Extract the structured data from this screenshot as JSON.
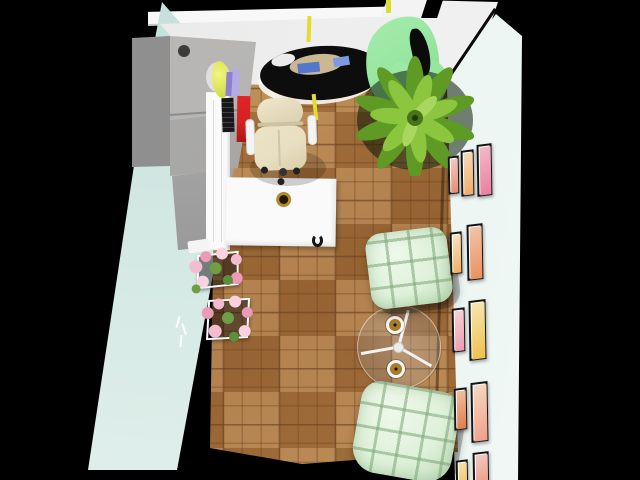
{
  "scene": {
    "type": "3d-room-render",
    "view": "top-down",
    "room": "home office",
    "objects": [
      {
        "id": "left-wall",
        "label": "Pale blue left wall"
      },
      {
        "id": "top-wall",
        "label": "White top wall"
      },
      {
        "id": "right-wall",
        "label": "Pale blue right wall with gallery of framed prints"
      },
      {
        "id": "parquet-floor",
        "label": "Oak square parquet floor"
      },
      {
        "id": "wardrobe",
        "label": "Grey wardrobe cabinet with round knob"
      },
      {
        "id": "desk",
        "label": "White L-shaped desk with brass knob"
      },
      {
        "id": "desk-books",
        "label": "Books and objects on desk: red book, dark book, purple books, lime lamp"
      },
      {
        "id": "office-chair",
        "label": "Cream office chair with white armrests and casters"
      },
      {
        "id": "round-black-table",
        "label": "Black round table with tableware decor"
      },
      {
        "id": "green-wave-decor",
        "label": "Green sculptural wave decor"
      },
      {
        "id": "potted-plant",
        "label": "Large green potted plant"
      },
      {
        "id": "tufted-chair-top",
        "label": "Mint tufted chair (upper)"
      },
      {
        "id": "tufted-chair-bottom",
        "label": "Mint tufted chair (lower)"
      },
      {
        "id": "glass-side-table",
        "label": "Round glass table with white tripod legs"
      },
      {
        "id": "brass-cups",
        "label": "Two brass cups on glass table",
        "count": 2
      },
      {
        "id": "flower-baskets",
        "label": "Two white wire baskets with pink flowers",
        "count": 2
      },
      {
        "id": "gallery-frames",
        "label": "Framed prints on right wall",
        "count": 11
      },
      {
        "id": "wall-sprig-decal",
        "label": "Small white sprig decal on left wall"
      }
    ],
    "counts": {
      "gallery_frames": 11,
      "flower_baskets": 2,
      "tufted_chairs": 2,
      "brass_cups": 2
    }
  },
  "colors": {
    "background": "#000000",
    "band-white": "#f8f8f8",
    "wall-left": "#d2e7e2",
    "wall-right": "#e9f4f1",
    "wall-top": "#ededed",
    "floor-base": "#b5824a",
    "floor-dark": "#a06b38",
    "cabinet-face": "#b2b1af",
    "cabinet-side": "#969696",
    "desk-white": "#fafafa",
    "chair-cream": "#e8dfc2",
    "mint": "#def1d9",
    "plant-dark": "#5f9a25",
    "plant-light": "#8cc63f",
    "wave-green": "#97e6a0",
    "accent-red": "#d42222",
    "accent-yellow": "#e3dd30",
    "flower-pink": "#f3bcd0",
    "flower-green": "#6f9e45",
    "frame-black": "#141414",
    "table-black": "#0d0d0d",
    "brass": "#b08a2f"
  }
}
